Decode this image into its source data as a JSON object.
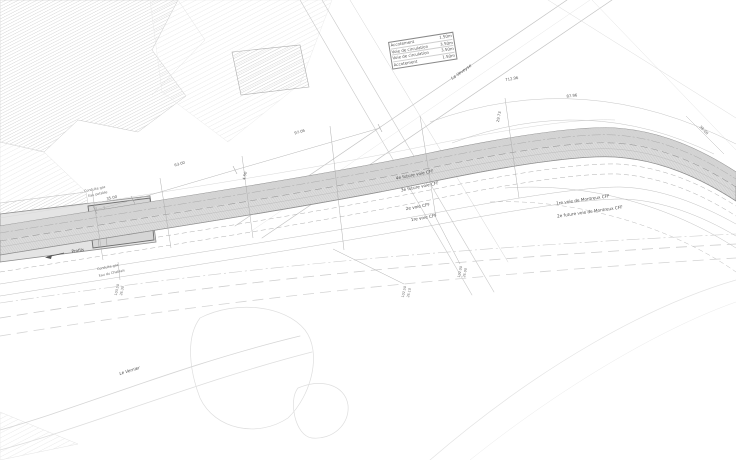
{
  "legend": {
    "rows": [
      {
        "label": "Accotement",
        "value": "1.50m"
      },
      {
        "label": "Voie de circulation",
        "value": "3.50m"
      },
      {
        "label": "Voie de circulation",
        "value": "3.50m"
      },
      {
        "label": "Accotement",
        "value": "1.50m"
      }
    ]
  },
  "labels": {
    "river": "La Veveyse",
    "stream": "Le Vernier",
    "profils": "Profils",
    "track_future_4": "4e future voie CFF",
    "track_future_3": "3e future voie CFF",
    "track_2": "2e voie CFF",
    "track_1": "1re voie CFF",
    "montreux_1": "1re voie de Montreux CFF",
    "montreux_2": "2e future voie de Montreux CFF",
    "pipe_upper_1": "Conduite gaz",
    "pipe_upper_2": "Eau potable",
    "pipe_lower_1": "Conduite gaz",
    "pipe_lower_2": "Eau du Chablais"
  },
  "dims": {
    "d35": "35.00",
    "d63": "63.00",
    "d97": "97.06",
    "d712": "712.96",
    "d87": "87.96",
    "d36": "36.00",
    "d29": "29.73",
    "d450": "4.50"
  },
  "stations": [
    {
      "a": "103.50",
      "b": "26.30"
    },
    {
      "a": "102.50",
      "b": "26.10"
    },
    {
      "a": "102.00",
      "b": "26.00"
    }
  ],
  "colors": {
    "band_fill": "#dcdcdc",
    "band_dark": "#d2d2d2",
    "edge_line": "#8a8a8a",
    "hatch": "#c2c2c2",
    "text": "#4f4f4f"
  }
}
